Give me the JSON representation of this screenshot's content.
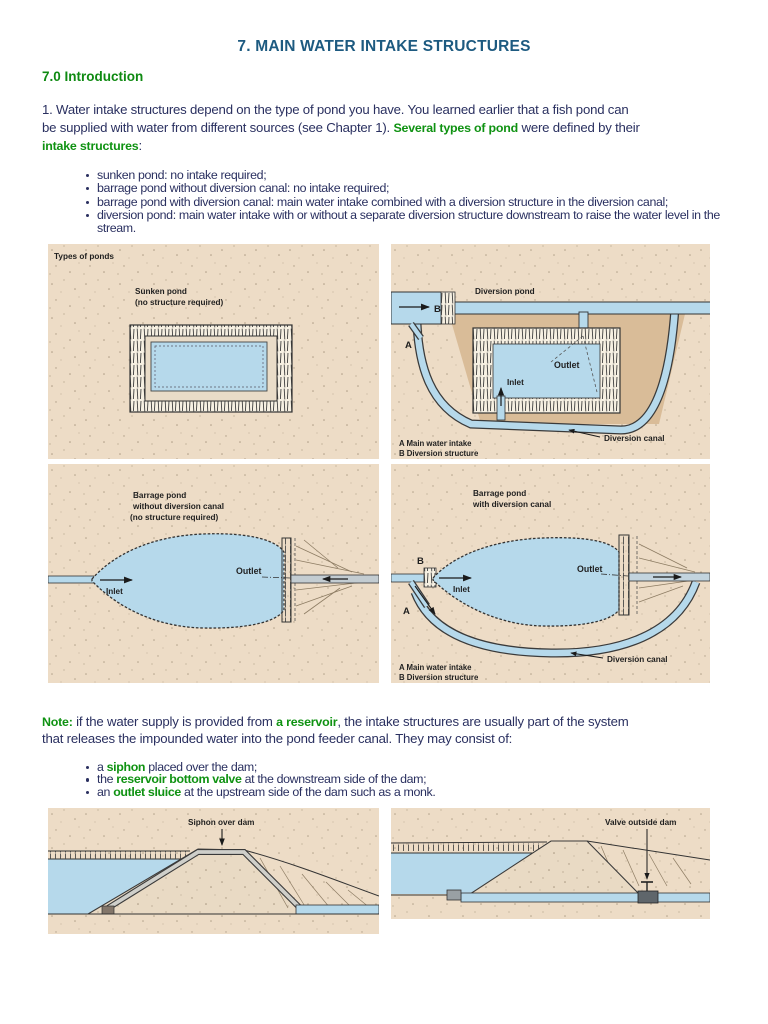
{
  "doc": {
    "title": "7. MAIN WATER INTAKE STRUCTURES",
    "section_heading": "7.0 Introduction",
    "p1": {
      "line1": "1. Water intake structures depend on the type of pond you have. You learned earlier that a fish pond can",
      "l2a": "be supplied with water from different sources (see Chapter 1). ",
      "l2b": "Several types of pond",
      "l2c": " were defined by their",
      "l3a": "intake structures",
      "l3b": ":"
    },
    "bullets1": [
      "sunken pond: no intake required;",
      "barrage pond without diversion canal: no intake required;",
      "barrage pond with diversion canal: main water intake combined with a diversion structure in the diversion canal;",
      "diversion pond: main water intake with or without a separate diversion structure downstream to raise the water level in the stream."
    ],
    "note": {
      "label": "Note:",
      "s1": " if the water supply is provided from ",
      "g1": "a reservoir",
      "s2": ", the intake structures are usually part of the system",
      "line2": "that releases the impounded water into the pond feeder canal. They may consist of:"
    },
    "bullets2": [
      {
        "pre": "a ",
        "term": "siphon",
        "post": " placed over the dam;"
      },
      {
        "pre": "the ",
        "term": "reservoir bottom valve",
        "post": " at the downstream side of the dam;"
      },
      {
        "pre": "an ",
        "term": "outlet sluice",
        "post": " at the upstream side of the dam such as a monk."
      }
    ]
  },
  "figures": {
    "types_caption": "Types of ponds",
    "sunken": {
      "l1": "Sunken pond",
      "l2": "(no structure required)"
    },
    "diversion": {
      "title": "Diversion pond",
      "outlet": "Outlet",
      "inlet": "Inlet",
      "canal": "Diversion canal",
      "a": "A",
      "b": "B",
      "legend_a": "A Main water intake",
      "legend_b": "B Diversion structure"
    },
    "barrage1": {
      "l1": "Barrage pond",
      "l2": "without diversion canal",
      "l3": "(no structure required)",
      "inlet": "Inlet",
      "outlet": "Outlet"
    },
    "barrage2": {
      "l1": "Barrage pond",
      "l2": "with diversion canal",
      "inlet": "Inlet",
      "outlet": "Outlet",
      "canal": "Diversion canal",
      "a": "A",
      "b": "B",
      "legend_a": "A Main water intake",
      "legend_b": "B Diversion structure"
    },
    "siphon": {
      "title": "Siphon over dam"
    },
    "valve": {
      "title": "Valve outside dam"
    }
  },
  "colors": {
    "title_blue": "#1d5a80",
    "green": "#0f9212",
    "body_navy": "#2a3060",
    "panel_beige": "#eddcc6",
    "water_blue": "#b6d9eb",
    "pond_brown": "#d9bc98"
  }
}
